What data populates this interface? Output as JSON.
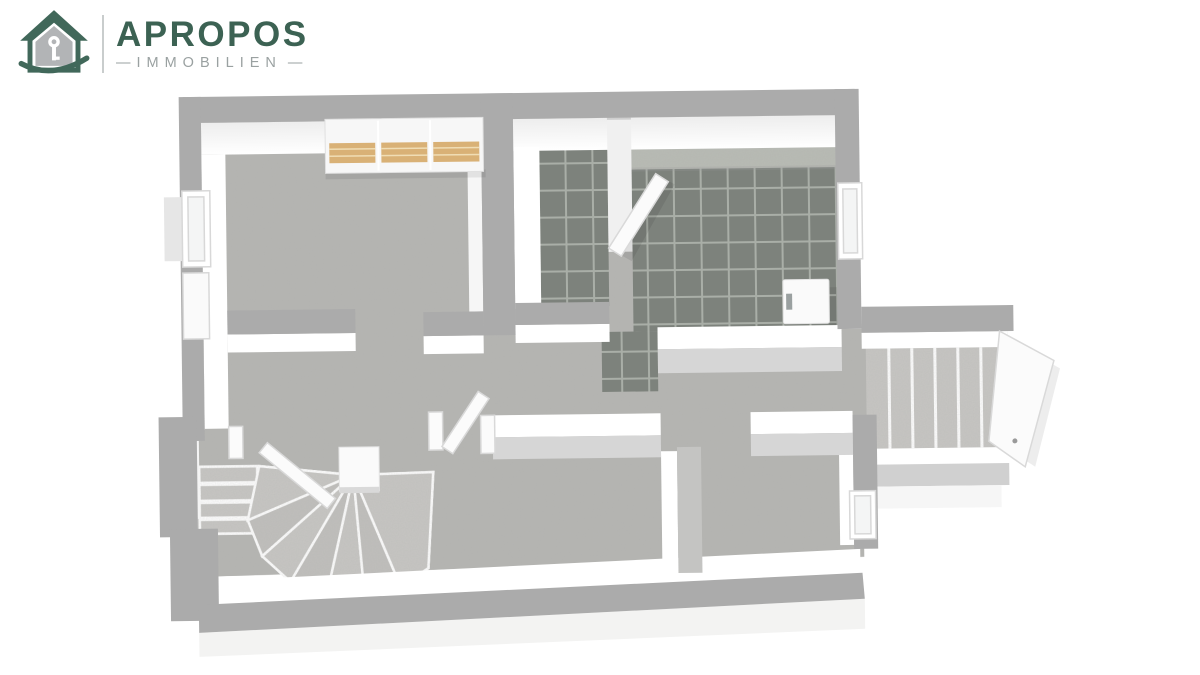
{
  "logo": {
    "brand": "APROPOS",
    "subtitle": "IMMOBILIEN",
    "dash": "—",
    "brand_color": "#3c6253",
    "subtitle_color": "#9aa1a1",
    "divider_color": "#c9cdcd",
    "house_green": "#41685a",
    "house_gray": "#b2b4b6"
  },
  "colors": {
    "background": "#ffffff",
    "wall_top": "#ababab",
    "wall_top_inner": "#d6d6d6",
    "wall_face": "#ffffff",
    "floor": "#b5b5b2",
    "floor_light": "#c7c6c3",
    "tile": "#7d827c",
    "tile_grout": "#a9aea7",
    "counter": "#b8bbb4",
    "wood": "#d9b176",
    "door": "#fbfbfb",
    "outer_face": "#f3f3f2"
  }
}
